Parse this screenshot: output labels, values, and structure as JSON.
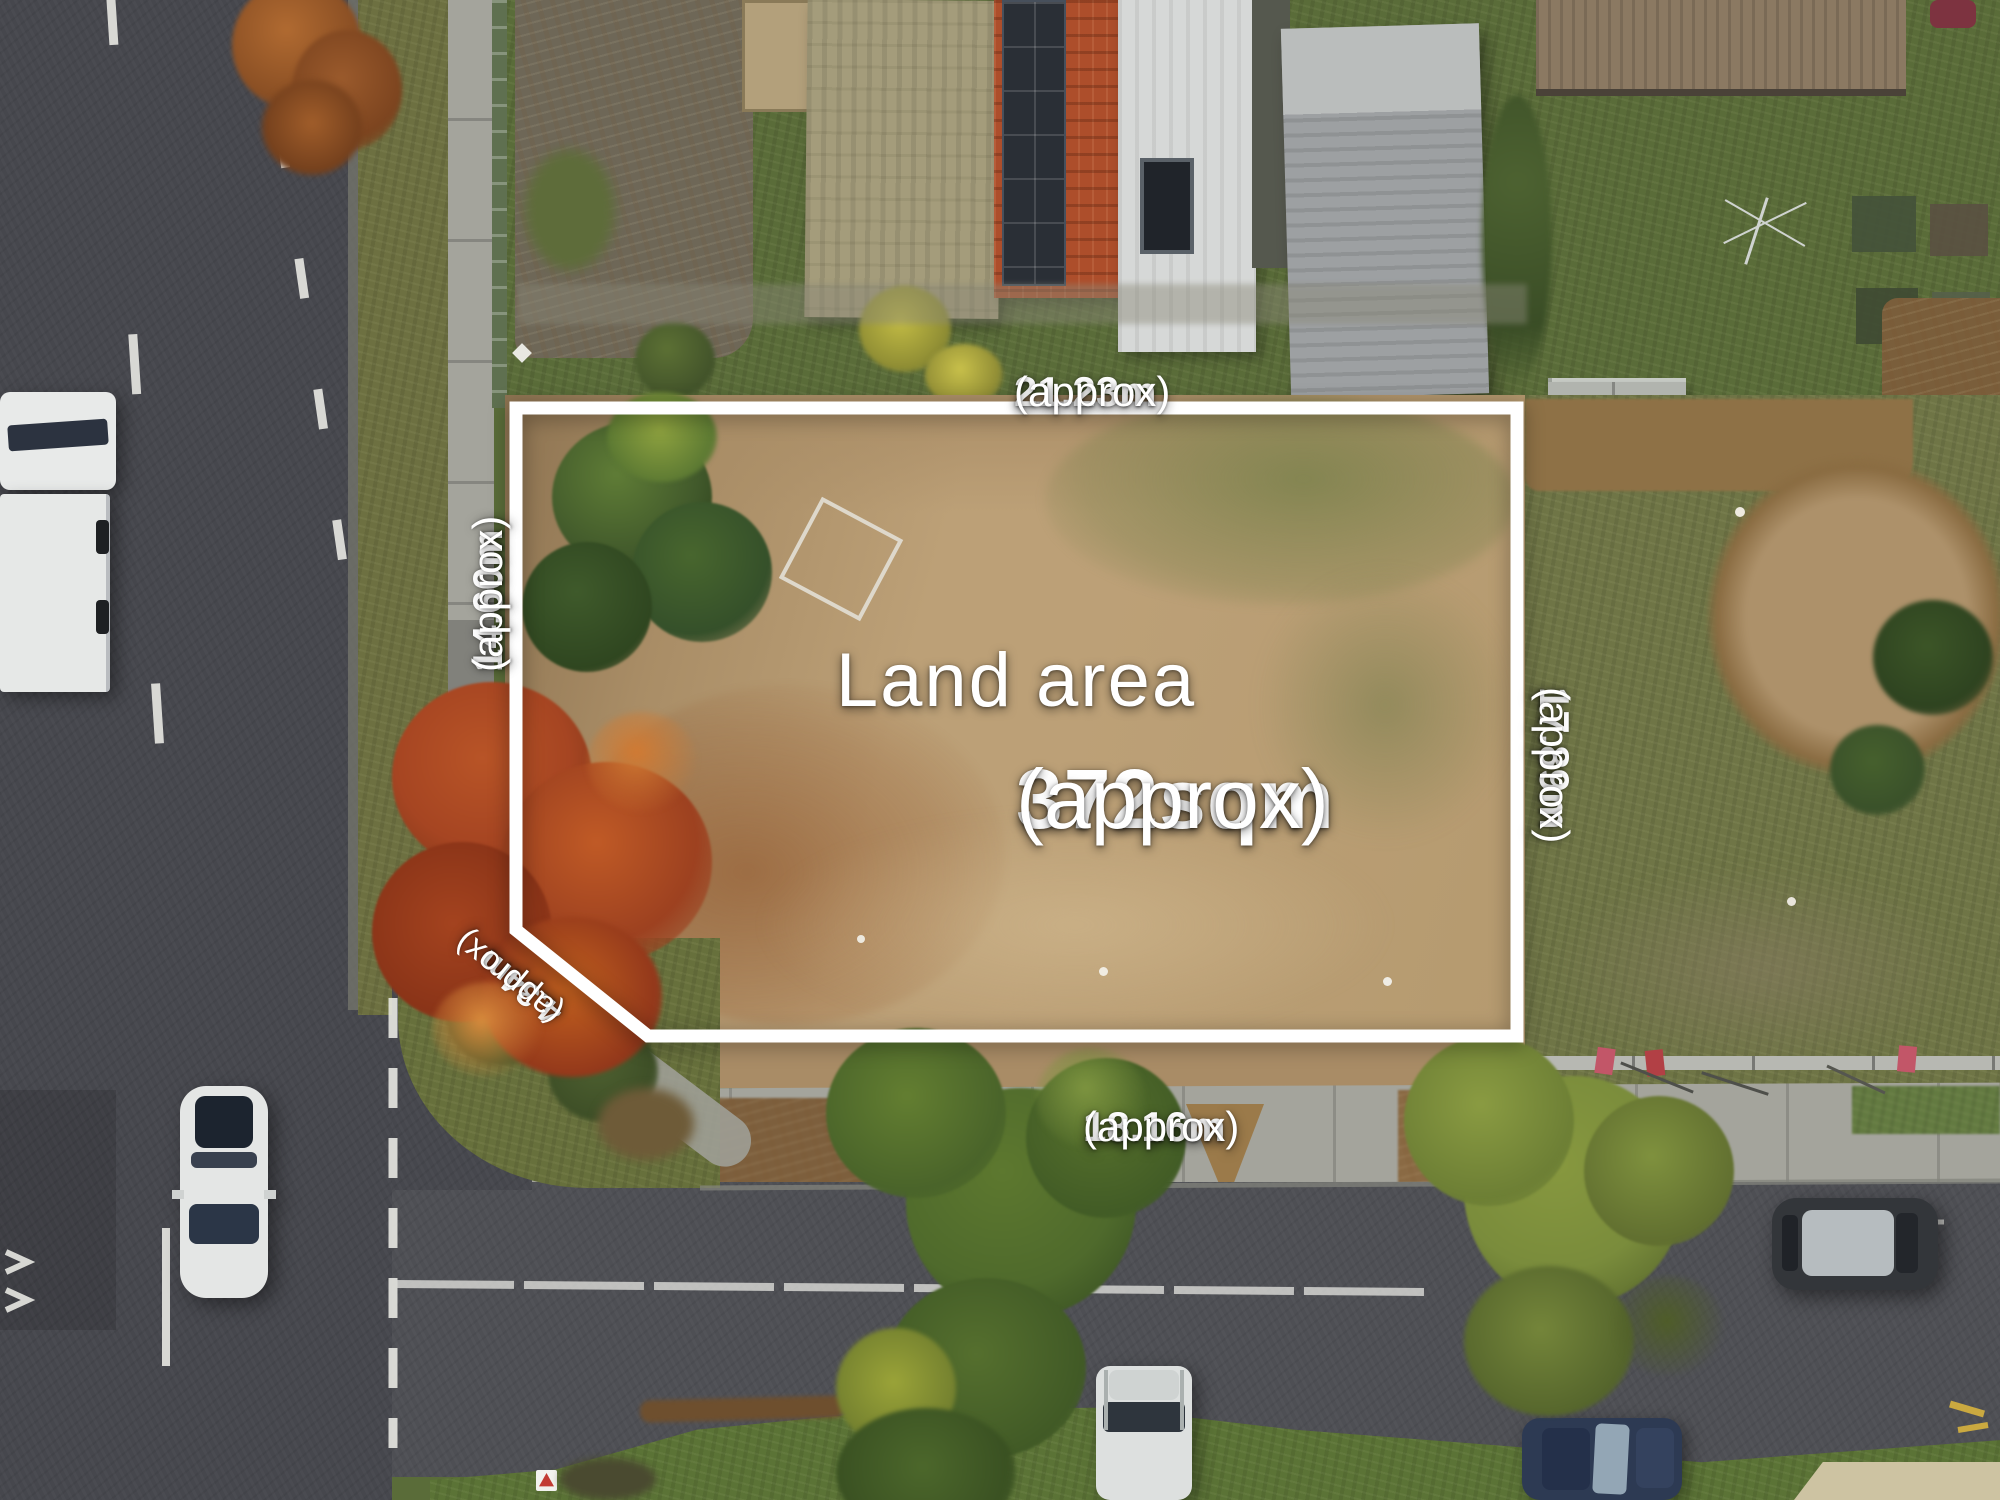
{
  "image": {
    "description": "Aerial drone photograph of a cleared residential land parcel outlined with a white boundary and dimension labels",
    "kind": "real-estate aerial lot photo"
  },
  "overlay": {
    "center": {
      "line1": "Land area",
      "value": "372sqm",
      "suffix": "(approx)"
    },
    "dimensions": {
      "top": {
        "value": "21.23m",
        "suffix": "(approx)"
      },
      "right": {
        "value": "17.89m",
        "suffix": "(approx)"
      },
      "bottom": {
        "value": "18.16m",
        "suffix": "(approx)"
      },
      "left": {
        "value": "14.60m",
        "suffix": "(approx)"
      },
      "corner": {
        "value": "4.34m",
        "suffix": "(approx)"
      }
    }
  },
  "palette": {
    "boundary": "#ffffff",
    "label-text": "#ffffff",
    "asphalt": "#46474d",
    "asphalt-2": "#4e4f54",
    "grass-verge": "#6d7041",
    "lawn": "#5a6c39",
    "dirt-parcel": "#bca077",
    "dirt-neighbor": "#8e7146",
    "footpath": "#a4a49c",
    "red-tree": "#b14a24",
    "conifer": "#41592b",
    "roof-red": "#ad4e2b",
    "roof-white": "#d6d8d7",
    "roof-gray": "#9da0a2",
    "roof-khaki": "#a49c7b",
    "roof-brown": "#8b7962",
    "marking-white": "#e9e9e4"
  }
}
